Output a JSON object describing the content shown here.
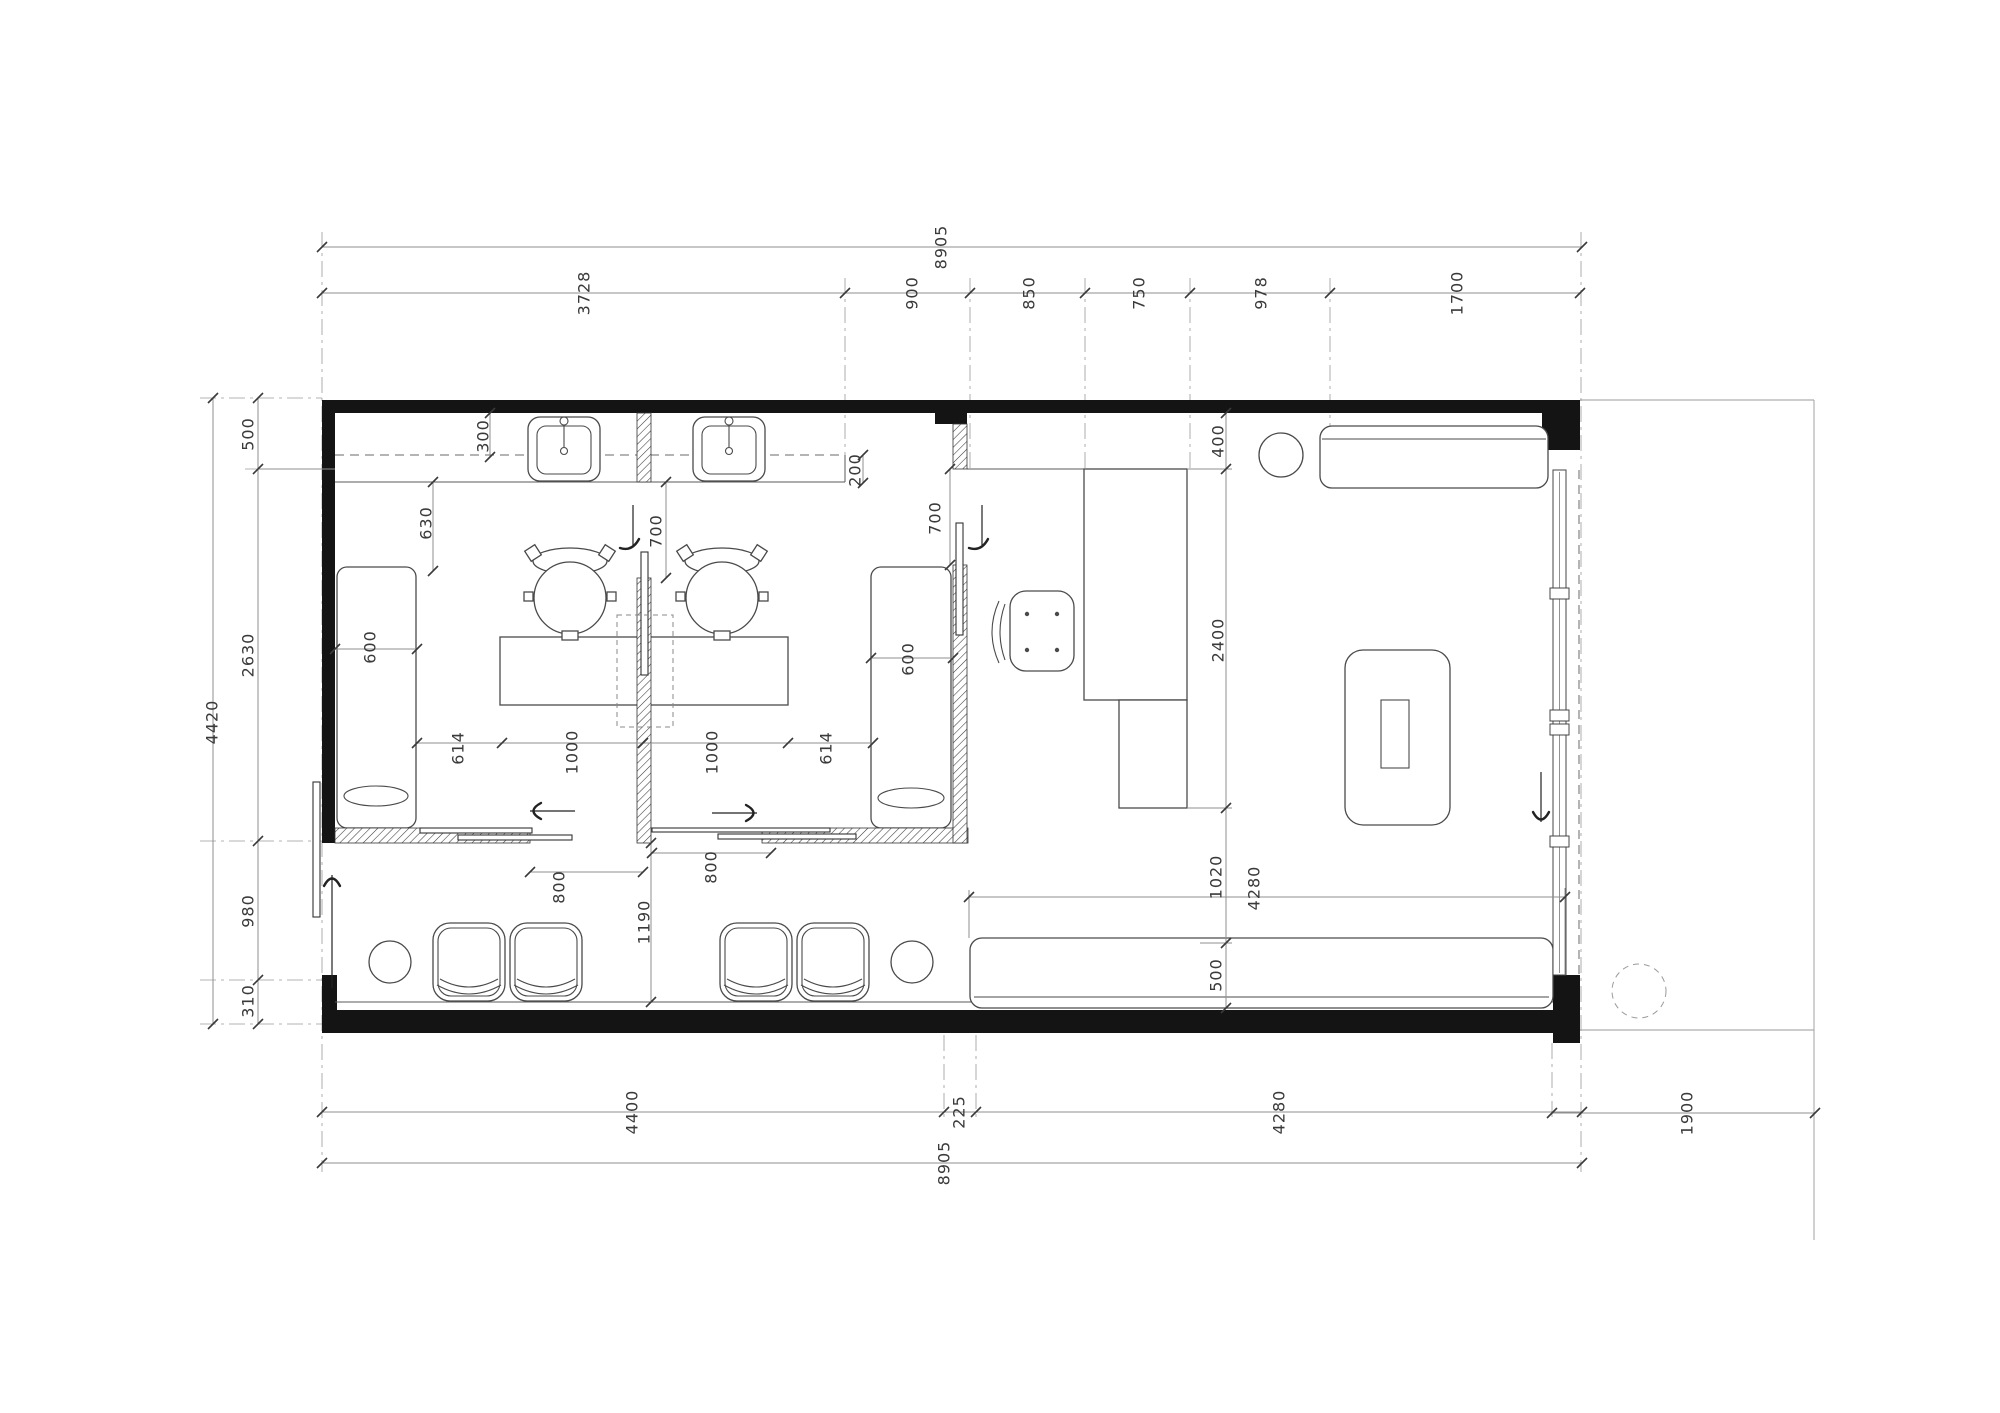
{
  "colors": {
    "wall": "#141414",
    "furniture_line": "#4a4a4a",
    "dimension_line": "#8f8f8f",
    "dimension_text": "#3a3a3a",
    "grid_line": "#9a9a9a"
  },
  "dims": {
    "top_overall": "8905",
    "top_seg_1": "3728",
    "top_seg_2": "900",
    "top_seg_3": "850",
    "top_seg_4": "750",
    "top_seg_5": "978",
    "top_seg_6": "1700",
    "left_overall": "4420",
    "left_seg_1": "500",
    "left_seg_2": "2630",
    "left_seg_3": "980",
    "left_seg_4": "310",
    "bottom_seg_1": "4400",
    "bottom_seg_2": "225",
    "bottom_seg_3": "4280",
    "bottom_overall": "8905",
    "site_right": "1900",
    "counter_soffit_depth": "300",
    "counter_front_offset": "200",
    "room1_wall_to_couch": "630",
    "room1_couch_width": "600",
    "room2_couch_width": "600",
    "desk_gap_left": "614",
    "desk_segment_1": "1000",
    "desk_segment_2": "1000",
    "desk_gap_right": "614",
    "room1_door_width": "700",
    "room2_door_width": "700",
    "room1_slide_opening": "800",
    "room2_slide_opening": "800",
    "corridor_width": "1190",
    "right_room_offset": "400",
    "reception_desk_length": "2400",
    "desk_to_bench_gap": "1020",
    "bench_depth": "500",
    "bench_length": "4280"
  }
}
